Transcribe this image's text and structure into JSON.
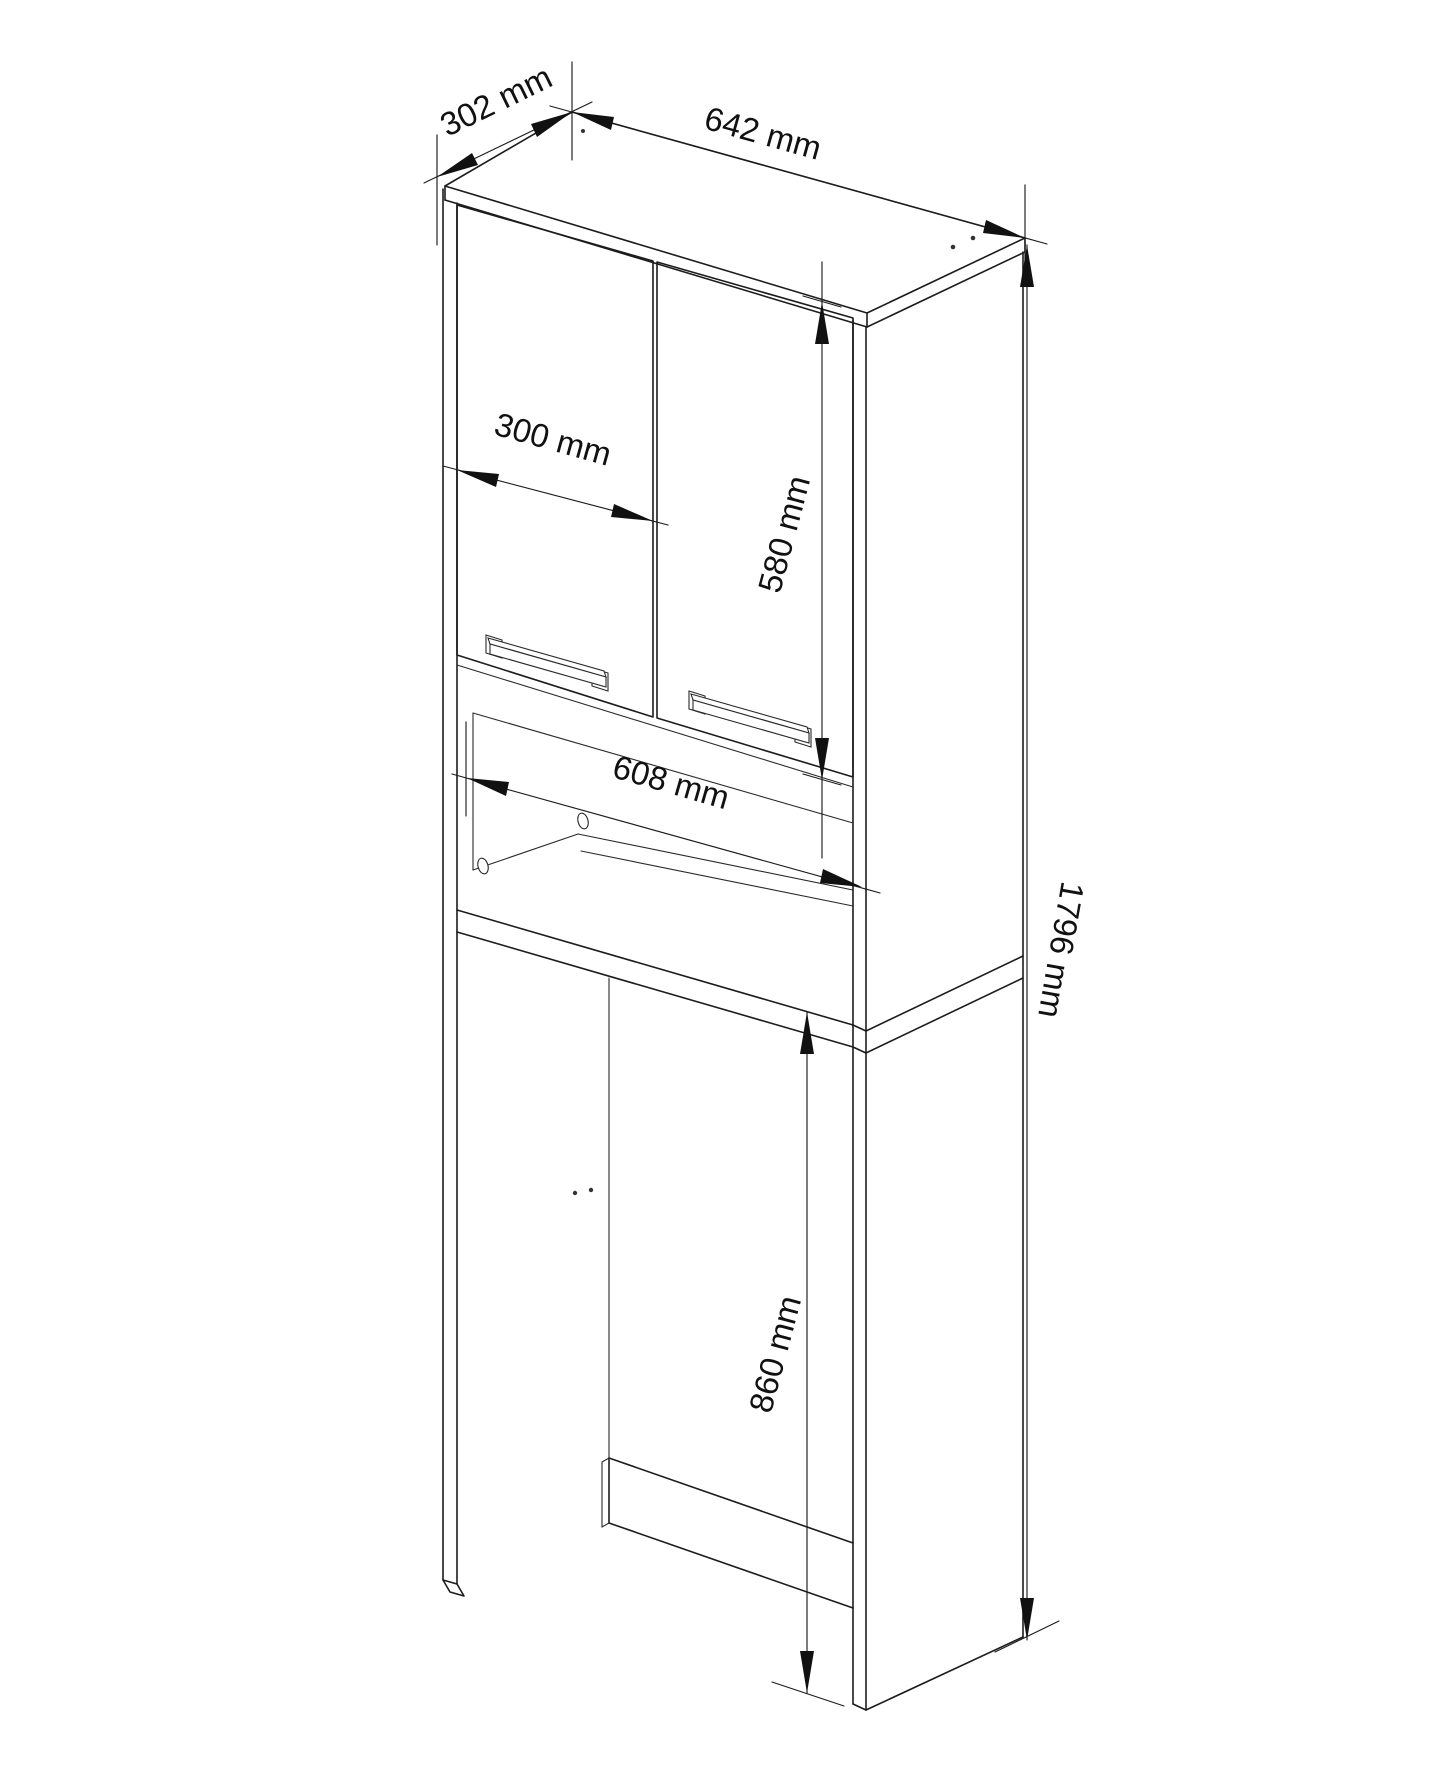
{
  "diagram": {
    "type": "furniture-technical-drawing",
    "subject": "tall bathroom cabinet over washing machine, isometric line drawing",
    "background_color": "#ffffff",
    "line_color": "#1c1c1c",
    "unit": "mm",
    "dimensions": {
      "depth": {
        "value": 302,
        "label": "302 mm"
      },
      "width": {
        "value": 642,
        "label": "642 mm"
      },
      "door_width": {
        "value": 300,
        "label": "300 mm"
      },
      "door_height": {
        "value": 580,
        "label": "580 mm"
      },
      "niche_width": {
        "value": 608,
        "label": "608 mm"
      },
      "total_height": {
        "value": 1796,
        "label": "1796 mm"
      },
      "washer_space_height": {
        "value": 860,
        "label": "860 mm"
      }
    }
  }
}
